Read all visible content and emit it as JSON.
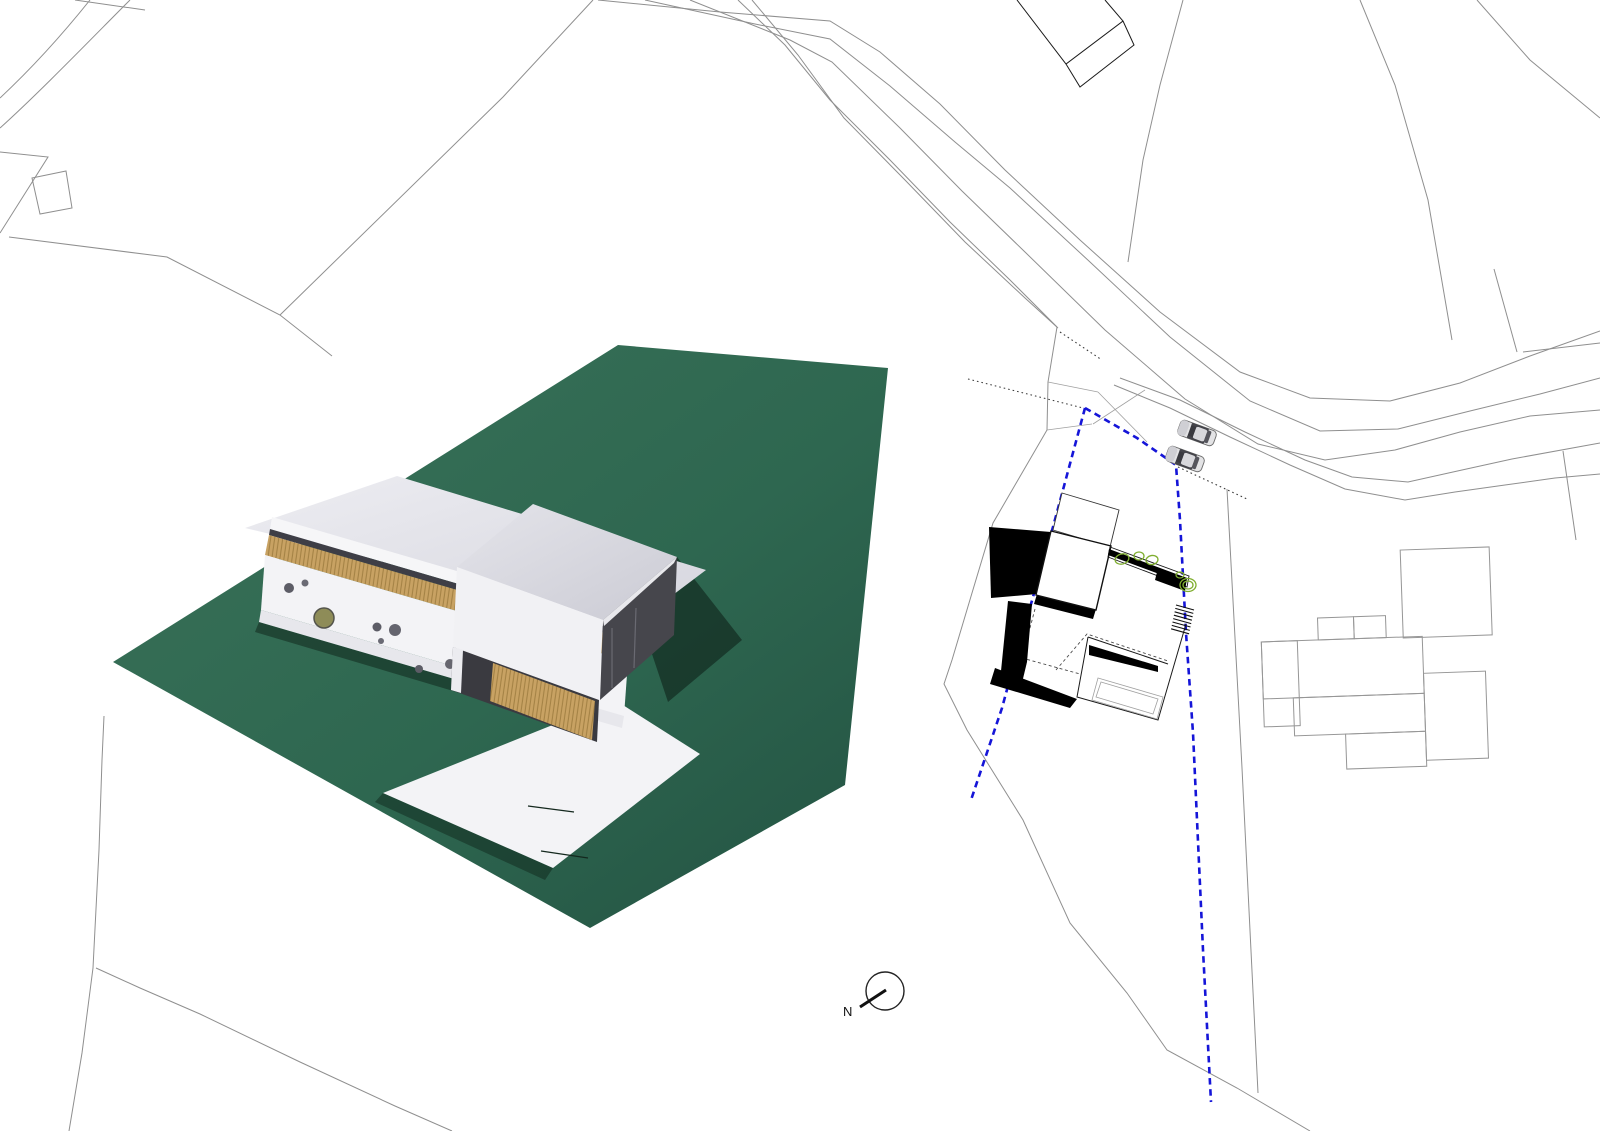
{
  "theme": {
    "page-bg": "#ffffff",
    "line-gray": "#8f8f8f",
    "line-dark": "#1a1a1a",
    "boundary-blue": "#1515d8",
    "tree-green": "#7fae2f",
    "base-green": "#2f6750",
    "wood-tan": "#c8a263",
    "wood-dark": "#a17f42",
    "card-white": "#f2f2f5",
    "roof-gray": "#e2e2e8",
    "glass-dark": "#46464c"
  },
  "site_plan": {
    "compass": {
      "label": "N"
    },
    "boundary_style": "blue-dashed",
    "cars_count": 2,
    "trees_count": 5
  },
  "model_photo": {
    "base_color": "#2f6750"
  }
}
